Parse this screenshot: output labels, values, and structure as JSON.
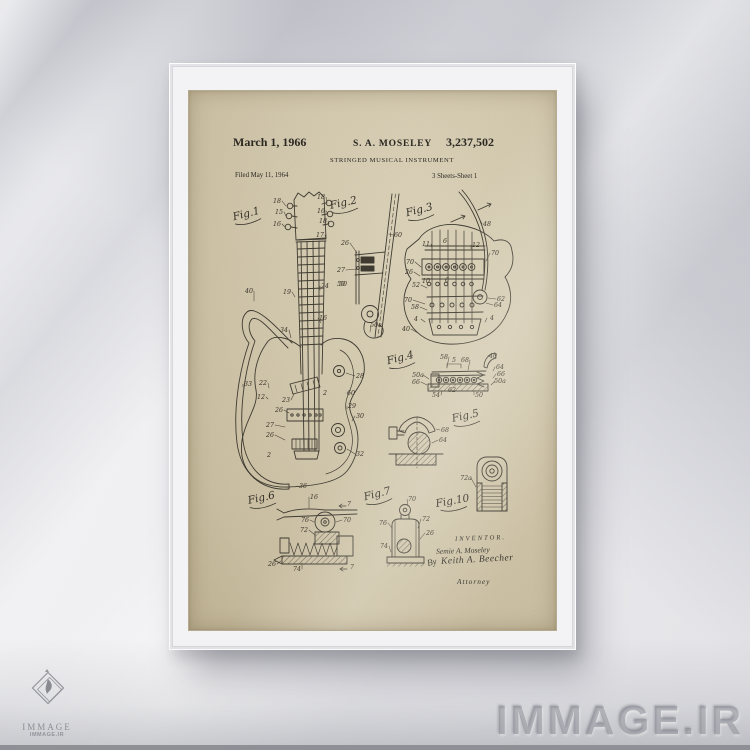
{
  "patent": {
    "date": "March 1, 1966",
    "inventor": "S. A. MOSELEY",
    "number": "3,237,502",
    "title": "STRINGED MUSICAL INSTRUMENT",
    "filed": "Filed May 11, 1964",
    "sheet": "3 Sheets-Sheet 1",
    "inventor_block": {
      "heading": "INVENTOR.",
      "name": "Semie A. Moseley",
      "by": "By",
      "signature": "Keith A. Beecher",
      "attorney": "Attorney"
    },
    "figure_labels": [
      {
        "label": "Fig.1",
        "x": 58,
        "y": 126,
        "rot": -14
      },
      {
        "label": "Fig.2",
        "x": 155,
        "y": 115,
        "rot": -12
      },
      {
        "label": "Fig.3",
        "x": 231,
        "y": 122,
        "rot": -14
      },
      {
        "label": "Fig.4",
        "x": 212,
        "y": 270,
        "rot": -14
      },
      {
        "label": "Fig.5",
        "x": 277,
        "y": 328,
        "rot": -12
      },
      {
        "label": "Fig.6",
        "x": 73,
        "y": 410,
        "rot": -12
      },
      {
        "label": "Fig.7",
        "x": 189,
        "y": 406,
        "rot": -14
      },
      {
        "label": "Fig.10",
        "x": 264,
        "y": 413,
        "rot": -10
      }
    ],
    "part_numbers": [
      {
        "t": "18",
        "x": 88,
        "y": 112,
        "l": [
          97,
          115
        ]
      },
      {
        "t": "15",
        "x": 90,
        "y": 123,
        "l": [
          97,
          125
        ]
      },
      {
        "t": "16",
        "x": 88,
        "y": 135,
        "l": [
          96,
          136
        ]
      },
      {
        "t": "18",
        "x": 132,
        "y": 108,
        "l": [
          138,
          112
        ]
      },
      {
        "t": "16",
        "x": 132,
        "y": 122,
        "l": [
          139,
          123
        ]
      },
      {
        "t": "18",
        "x": 134,
        "y": 132,
        "l": [
          140,
          133
        ]
      },
      {
        "t": "17",
        "x": 131,
        "y": 146,
        "l": [
          137,
          148
        ]
      },
      {
        "t": "24",
        "x": 136,
        "y": 197,
        "l": [
          131,
          199
        ]
      },
      {
        "t": "50",
        "x": 152,
        "y": 195
      },
      {
        "t": "16",
        "x": 134,
        "y": 229,
        "l": [
          132,
          232
        ]
      },
      {
        "t": "19",
        "x": 98,
        "y": 203,
        "l": [
          106,
          206
        ]
      },
      {
        "t": "40",
        "x": 60,
        "y": 202,
        "l": [
          65,
          210
        ]
      },
      {
        "t": "34",
        "x": 95,
        "y": 241,
        "l": [
          102,
          247
        ]
      },
      {
        "t": "33",
        "x": 59,
        "y": 295,
        "l": [
          54,
          296
        ]
      },
      {
        "t": "22",
        "x": 74,
        "y": 294,
        "l": [
          80,
          297
        ]
      },
      {
        "t": "12",
        "x": 72,
        "y": 308,
        "l": [
          79,
          308
        ]
      },
      {
        "t": "23",
        "x": 97,
        "y": 311,
        "l": [
          105,
          303
        ]
      },
      {
        "t": "26",
        "x": 90,
        "y": 321,
        "l": [
          100,
          322
        ]
      },
      {
        "t": "27",
        "x": 81,
        "y": 336,
        "l": [
          96,
          336
        ]
      },
      {
        "t": "26",
        "x": 81,
        "y": 346,
        "l": [
          96,
          349
        ]
      },
      {
        "t": "2",
        "x": 80,
        "y": 366
      },
      {
        "t": "2",
        "x": 136,
        "y": 304
      },
      {
        "t": "28",
        "x": 171,
        "y": 287,
        "l": [
          157,
          282
        ]
      },
      {
        "t": "60",
        "x": 162,
        "y": 304,
        "l": [
          157,
          302
        ]
      },
      {
        "t": "29",
        "x": 163,
        "y": 317,
        "l": [
          158,
          318
        ]
      },
      {
        "t": "30",
        "x": 171,
        "y": 327,
        "l": [
          163,
          330
        ]
      },
      {
        "t": "32",
        "x": 171,
        "y": 365,
        "l": [
          158,
          358
        ]
      },
      {
        "t": "36",
        "x": 114,
        "y": 397,
        "l": [
          106,
          396
        ]
      },
      {
        "t": "26",
        "x": 156,
        "y": 154,
        "l": [
          168,
          162
        ]
      },
      {
        "t": "27",
        "x": 152,
        "y": 181,
        "l": [
          169,
          178
        ]
      },
      {
        "t": "50",
        "x": 154,
        "y": 195
      },
      {
        "t": "50a",
        "x": 187,
        "y": 236,
        "l": [
          181,
          241
        ]
      },
      {
        "t": "60",
        "x": 209,
        "y": 146,
        "l": [
          200,
          143
        ]
      },
      {
        "t": "48",
        "x": 298,
        "y": 135,
        "l": [
          291,
          129
        ]
      },
      {
        "t": "11",
        "x": 237,
        "y": 155,
        "l": [
          243,
          157
        ]
      },
      {
        "t": "6",
        "x": 256,
        "y": 152
      },
      {
        "t": "12",
        "x": 287,
        "y": 156,
        "l": [
          282,
          158
        ]
      },
      {
        "t": "70",
        "x": 306,
        "y": 164,
        "l": [
          297,
          170
        ]
      },
      {
        "t": "70",
        "x": 221,
        "y": 173,
        "l": [
          232,
          176
        ]
      },
      {
        "t": "26",
        "x": 220,
        "y": 183,
        "l": [
          231,
          185
        ]
      },
      {
        "t": "52",
        "x": 227,
        "y": 196,
        "l": [
          238,
          197
        ]
      },
      {
        "t": "10",
        "x": 237,
        "y": 192
      },
      {
        "t": "6",
        "x": 258,
        "y": 191
      },
      {
        "t": "70",
        "x": 219,
        "y": 211,
        "l": [
          236,
          213
        ]
      },
      {
        "t": "58",
        "x": 226,
        "y": 218,
        "l": [
          238,
          219
        ]
      },
      {
        "t": "62",
        "x": 312,
        "y": 210,
        "l": [
          299,
          207
        ]
      },
      {
        "t": "64",
        "x": 309,
        "y": 216,
        "l": [
          297,
          212
        ]
      },
      {
        "t": "4",
        "x": 227,
        "y": 230,
        "l": [
          236,
          231
        ]
      },
      {
        "t": "4",
        "x": 303,
        "y": 229,
        "l": [
          296,
          231
        ]
      },
      {
        "t": "40",
        "x": 217,
        "y": 240,
        "l": [
          229,
          242
        ]
      },
      {
        "t": "58",
        "x": 255,
        "y": 268,
        "l": [
          258,
          276
        ]
      },
      {
        "t": "5",
        "x": 265,
        "y": 271
      },
      {
        "t": "68",
        "x": 276,
        "y": 271,
        "l": [
          279,
          279
        ]
      },
      {
        "t": "40",
        "x": 304,
        "y": 267,
        "l": [
          302,
          263
        ]
      },
      {
        "t": "64",
        "x": 311,
        "y": 278,
        "l": [
          304,
          280
        ]
      },
      {
        "t": "66",
        "x": 312,
        "y": 285,
        "l": [
          304,
          287
        ]
      },
      {
        "t": "50a",
        "x": 229,
        "y": 286,
        "l": [
          240,
          288
        ]
      },
      {
        "t": "66",
        "x": 227,
        "y": 293,
        "l": [
          238,
          294
        ]
      },
      {
        "t": "50a",
        "x": 311,
        "y": 292,
        "l": [
          302,
          294
        ]
      },
      {
        "t": "50",
        "x": 290,
        "y": 306,
        "l": [
          285,
          300
        ]
      },
      {
        "t": "54",
        "x": 247,
        "y": 306,
        "l": [
          253,
          300
        ]
      },
      {
        "t": "62",
        "x": 263,
        "y": 301
      },
      {
        "t": "68",
        "x": 256,
        "y": 341,
        "l": [
          247,
          338
        ]
      },
      {
        "t": "64",
        "x": 254,
        "y": 351,
        "l": [
          243,
          352
        ]
      },
      {
        "t": "16",
        "x": 125,
        "y": 408,
        "l": [
          120,
          417
        ]
      },
      {
        "t": "7",
        "x": 160,
        "y": 415
      },
      {
        "t": "76",
        "x": 116,
        "y": 431,
        "l": [
          125,
          431
        ]
      },
      {
        "t": "70",
        "x": 158,
        "y": 431,
        "l": [
          147,
          431
        ]
      },
      {
        "t": "72",
        "x": 115,
        "y": 441,
        "l": [
          126,
          444
        ]
      },
      {
        "t": "26",
        "x": 83,
        "y": 475,
        "l": [
          92,
          470
        ]
      },
      {
        "t": "74",
        "x": 108,
        "y": 480,
        "l": [
          113,
          472
        ]
      },
      {
        "t": "7",
        "x": 163,
        "y": 478
      },
      {
        "t": "70",
        "x": 223,
        "y": 410,
        "l": [
          219,
          415
        ]
      },
      {
        "t": "76",
        "x": 194,
        "y": 434,
        "l": [
          203,
          437
        ]
      },
      {
        "t": "72",
        "x": 237,
        "y": 430,
        "l": [
          229,
          437
        ]
      },
      {
        "t": "26",
        "x": 241,
        "y": 444,
        "l": [
          231,
          448
        ]
      },
      {
        "t": "74",
        "x": 195,
        "y": 457,
        "l": [
          202,
          461
        ]
      },
      {
        "t": "72a",
        "x": 277,
        "y": 389,
        "l": [
          287,
          396
        ]
      }
    ]
  },
  "watermarks": {
    "corner_text": "IMMAGE.IR",
    "logo_title": "IMMAGE",
    "logo_subtitle": "IMMAGE.IR"
  },
  "colors": {
    "paper": "#d3c9ae",
    "ink": "#332f27",
    "wall": "#ececef",
    "frame": "#f3f3f5"
  }
}
